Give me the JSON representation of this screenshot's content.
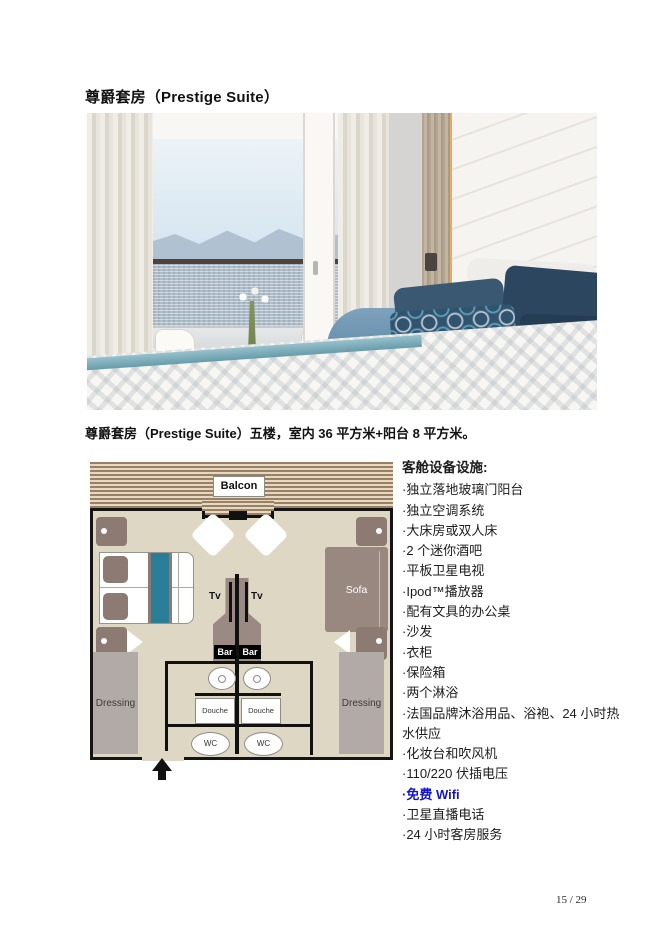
{
  "page": {
    "title": "尊爵套房（Prestige Suite）",
    "caption": "尊爵套房（Prestige Suite）五楼，室内 36 平方米+阳台 8 平方米。",
    "page_number": "15 / 29"
  },
  "floorplan": {
    "balcony_label": "Balcon",
    "tv_label": "Tv",
    "bar_label": "Bar",
    "sofa_label": "Sofa",
    "shower_label": "Douche",
    "wc_label": "WC",
    "dressing_label": "Dressing"
  },
  "amenities": {
    "header": "客舱设备设施:",
    "items": [
      "·独立落地玻璃门阳台",
      "·独立空调系统",
      "·大床房或双人床",
      "·2 个迷你酒吧",
      "·平板卫星电视",
      "·Ipod™播放器",
      "·配有文具的办公桌",
      "·沙发",
      "·衣柜",
      "·保险箱",
      "·两个淋浴",
      "·法国品牌沐浴用品、浴袍、24 小时热水供应",
      "·化妆台和吹风机",
      "·110/220 伏插电压",
      "·免费 Wifi",
      "·卫星直播电话",
      "·24 小时客房服务"
    ],
    "highlight_item": "·免费 Wifi",
    "highlight_color": "#1414cc"
  },
  "colors": {
    "wifi_link": "#1414cc",
    "plan_floor": "#ded7c3",
    "plan_furniture_brown": "#8d7b73",
    "plan_teal": "#2a7e97",
    "plan_dressing_gray": "#b2aaa6",
    "pillow_navy": "#2c4660"
  }
}
